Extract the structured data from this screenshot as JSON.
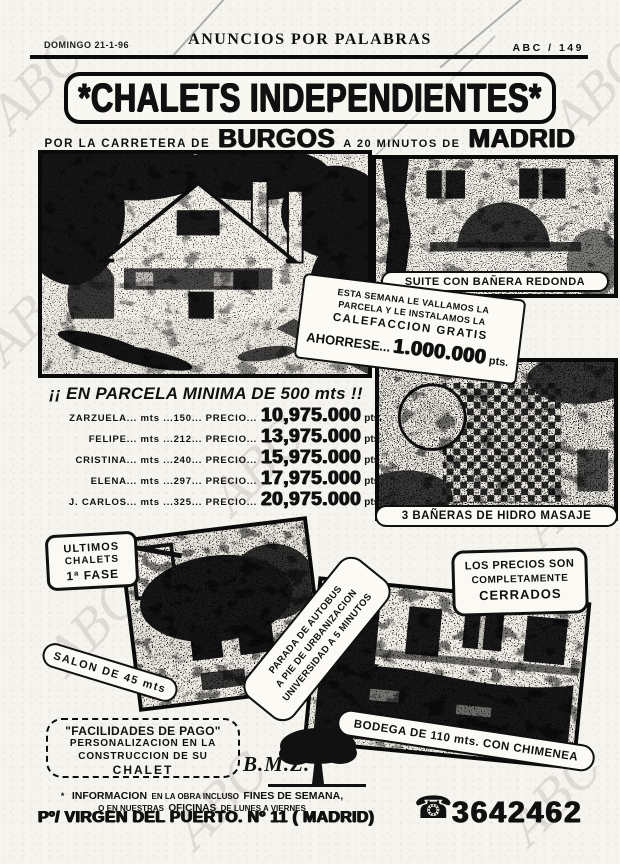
{
  "page": {
    "paper_color": "#f6f4ee",
    "ink_color": "#101010",
    "watermark_text": "ABC"
  },
  "header": {
    "date": "DOMINGO 21-1-96",
    "section_title": "ANUNCIOS POR PALABRAS",
    "page_ref": "ABC / 149"
  },
  "ad": {
    "title": "*CHALETS INDEPENDIENTES*",
    "subtitle": {
      "lead": "POR LA CARRETERA DE",
      "city1": "BURGOS",
      "mid": "A 20 MINUTOS DE",
      "city2": "MADRID"
    },
    "coupon": {
      "line1": "ESTA SEMANA LE VALLAMOS LA",
      "line2": "PARCELA Y LE INSTALAMOS LA",
      "line3": "CALEFACCION GRATIS",
      "save_label": "AHORRESE...",
      "save_amount": "1.000.000",
      "save_unit": "pts."
    },
    "parcel_headline": "¡¡ EN PARCELA MINIMA DE 500 mts !!",
    "price_list": [
      {
        "lead": "ZARZUELA... mts ...150... PRECIO...",
        "price": "10,975.000",
        "unit": "pts."
      },
      {
        "lead": "FELIPE... mts ...212... PRECIO...",
        "price": "13,975.000",
        "unit": "pts."
      },
      {
        "lead": "CRISTINA... mts ...240... PRECIO...",
        "price": "15,975.000",
        "unit": "pts."
      },
      {
        "lead": "ELENA... mts ...297... PRECIO...",
        "price": "17,975.000",
        "unit": "pts."
      },
      {
        "lead": "J. CARLOS... mts ...325... PRECIO...",
        "price": "20,975.000",
        "unit": "pts."
      }
    ],
    "photo_captions": {
      "suite": "SUITE CON BAÑERA REDONDA",
      "banos": "3 BAÑERAS DE HIDRO MASAJE",
      "salon": "SALON DE 45 mts",
      "bodega": "BODEGA DE 110 mts. CON CHIMENEA"
    },
    "bubbles": {
      "ultimos": {
        "l1": "ULTIMOS",
        "l2": "CHALETS",
        "l3": "1ª FASE"
      },
      "parada": {
        "l1": "PARADA DE AUTOBUS",
        "l2": "A PIE DE URBANIZACION",
        "l3": "UNIVERSIDAD A 5 MINUTOS"
      },
      "precios": {
        "l1": "LOS PRECIOS SON",
        "l2": "COMPLETAMENTE",
        "l3": "CERRADOS"
      }
    },
    "facilidades": {
      "l1": "\"FACILIDADES DE PAGO\"",
      "l2": "PERSONALIZACION EN LA",
      "l3": "CONSTRUCCION DE SU",
      "l4": "CHALET"
    },
    "brand": {
      "name": "B.M.Z.",
      "logo": "tree"
    },
    "info": {
      "bullet": "*",
      "s1": "INFORMACION",
      "s2": "EN LA OBRA INCLUSO",
      "s3": "FINES DE SEMANA,",
      "s4": "O EN NUESTRAS",
      "s5": "OFICINAS",
      "s6": "DE LUNES A VIERNES"
    },
    "footer": {
      "address": "Pº/ VIRGEN DEL PUERTO. Nº 11 ( MADRID)",
      "phone_glyph": "☎",
      "phone": "3642462"
    }
  }
}
